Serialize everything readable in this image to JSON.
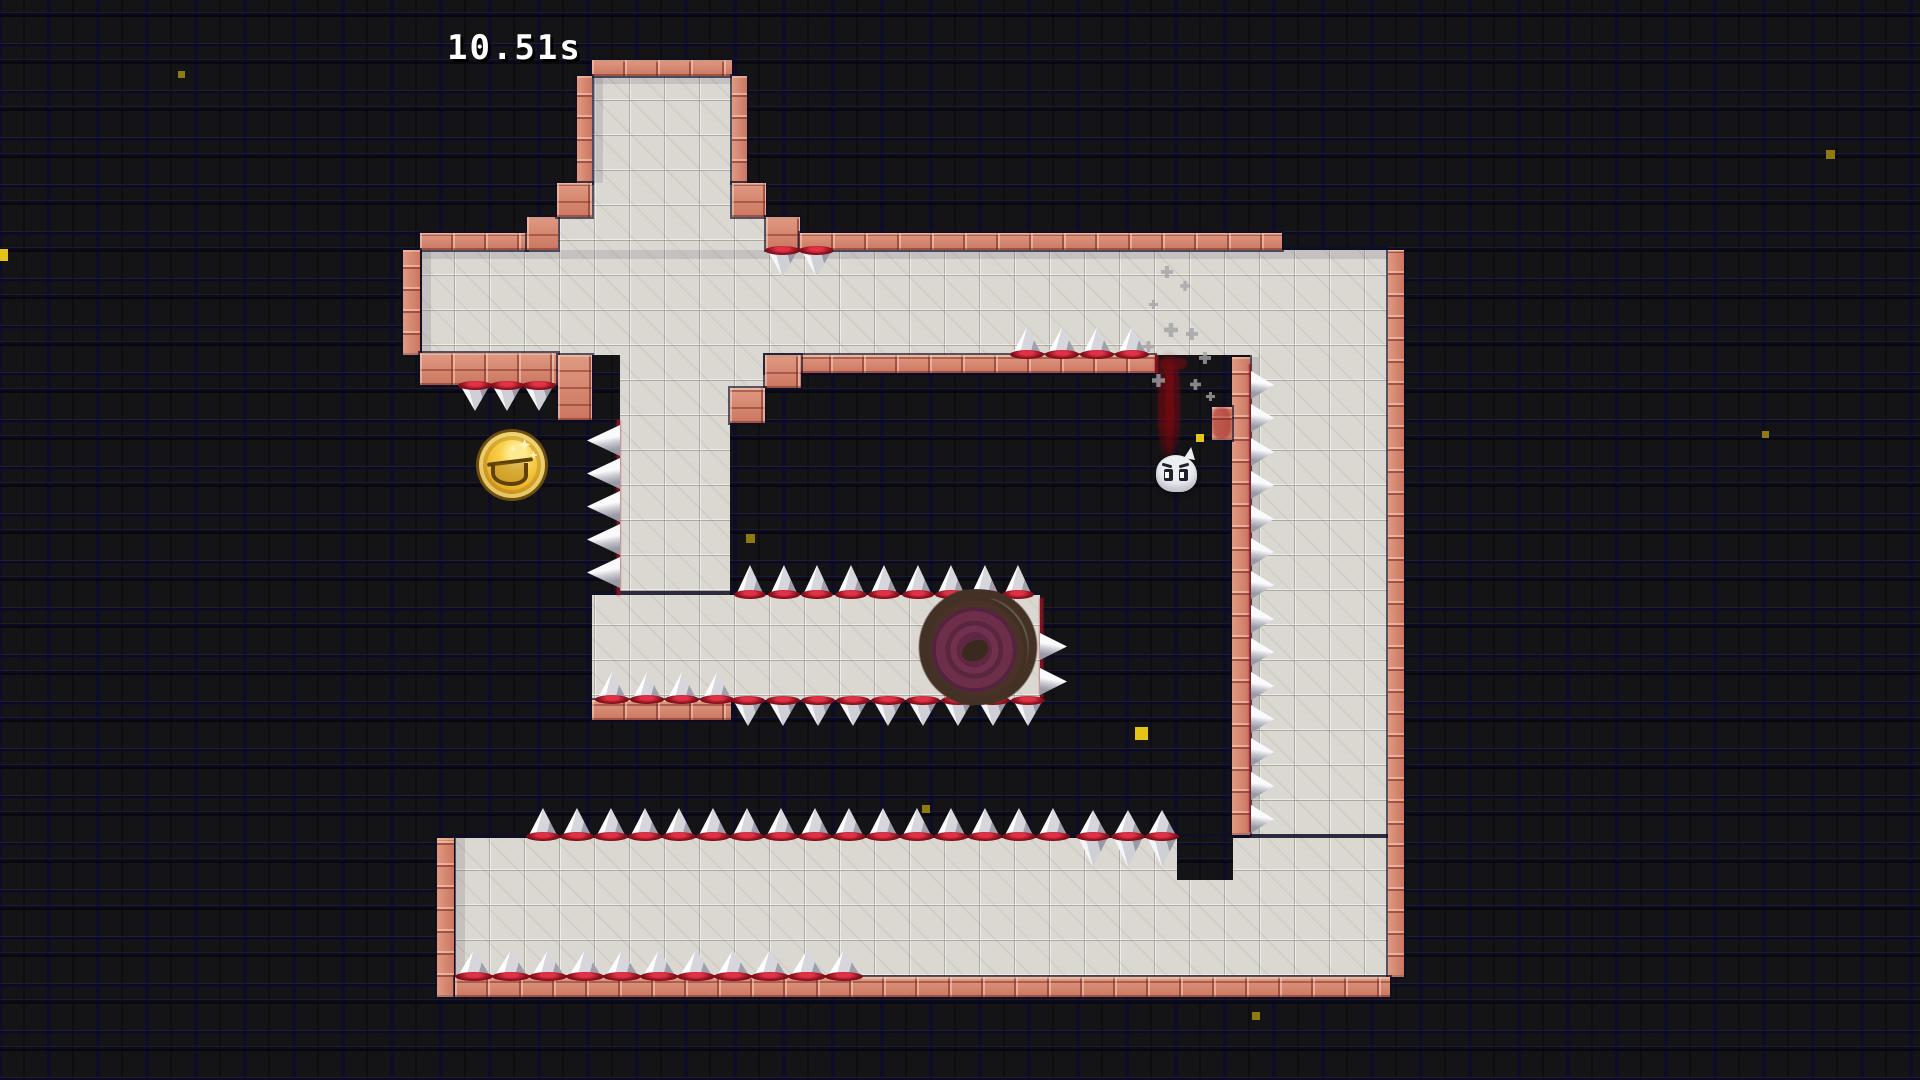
{
  "hud": {
    "timer": "10.51s"
  },
  "palette": {
    "background_tile": "#141417",
    "grout_navy": "#0e0e26",
    "platform_gray": "#dbd8d2",
    "brick_pink": "#d5806a",
    "spike_white": "#f5f5f7",
    "spike_ring_red": "#93121f",
    "coin_gold": "#edb92f",
    "portal_maroon": "#6d2e4a",
    "portal_brown": "#443126",
    "blood_red": "#8b0a0e",
    "particle_yellow": "#e4c418",
    "smoke_gray": "#a3a3a6"
  },
  "entities": {
    "coin": {
      "x": 479,
      "y": 432,
      "size": 66
    },
    "portal": {
      "x": 922,
      "y": 596,
      "w": 112,
      "h": 102
    },
    "ghost": {
      "x": 1156,
      "y": 455,
      "w": 41,
      "h": 37
    },
    "blood": {
      "streaks": [
        {
          "x": 1158,
          "y": 350,
          "w": 22,
          "h": 110,
          "o": 0.5
        },
        {
          "x": 1165,
          "y": 357,
          "w": 9,
          "h": 100,
          "o": 0.55
        }
      ],
      "pool": {
        "x": 1159,
        "y": 357,
        "w": 28,
        "h": 13,
        "o": 0.5
      },
      "wall_smear": {
        "x": 1212,
        "y": 407,
        "w": 19,
        "h": 32,
        "o": 0.45
      }
    },
    "smoke_puffs": [
      [
        1161,
        266,
        12
      ],
      [
        1180,
        281,
        10
      ],
      [
        1149,
        300,
        9
      ],
      [
        1164,
        323,
        14
      ],
      [
        1186,
        328,
        12
      ],
      [
        1143,
        341,
        11
      ],
      [
        1199,
        352,
        12
      ],
      [
        1152,
        374,
        13
      ],
      [
        1190,
        379,
        11
      ],
      [
        1206,
        392,
        9
      ]
    ],
    "particles": [
      [
        -4,
        249,
        12,
        1
      ],
      [
        178,
        71,
        7,
        0
      ],
      [
        746,
        534,
        9,
        0
      ],
      [
        922,
        805,
        8,
        0
      ],
      [
        1135,
        727,
        13,
        1
      ],
      [
        1196,
        434,
        8,
        1
      ],
      [
        1252,
        1012,
        8,
        0
      ],
      [
        1826,
        150,
        9,
        0
      ],
      [
        1762,
        431,
        7,
        0
      ]
    ]
  },
  "spikes": {
    "rows": [
      {
        "name": "band-ceiling-spikes",
        "dir": "down",
        "x": 767,
        "y": 250,
        "n": 2,
        "step": 34,
        "w": 31,
        "h": 27,
        "ring": true,
        "shadow": false
      },
      {
        "name": "band-floor-spikes",
        "dir": "up",
        "x": 1012,
        "y": 355,
        "n": 4,
        "step": 35,
        "w": 30,
        "h": 28,
        "ring": true,
        "shadow": true
      },
      {
        "name": "left-ledge-down-spikes",
        "dir": "down",
        "x": 460,
        "y": 385,
        "n": 3,
        "step": 32,
        "w": 30,
        "h": 26,
        "ring": true,
        "shadow": false
      },
      {
        "name": "coin-wall-spikes",
        "dir": "left",
        "x": 620,
        "y": 425,
        "n": 5,
        "step": 33,
        "w": 33,
        "h": 31,
        "ring": false,
        "shadow": false
      },
      {
        "name": "column-floor-spikes",
        "dir": "up",
        "x": 597,
        "y": 700,
        "n": 4,
        "step": 35,
        "w": 30,
        "h": 28,
        "ring": true,
        "shadow": false
      },
      {
        "name": "stub-top-spikes",
        "dir": "up",
        "x": 736,
        "y": 595,
        "n": 9,
        "step": 33.5,
        "w": 28,
        "h": 30,
        "ring": true,
        "shadow": true
      },
      {
        "name": "stub-bottom-spikes",
        "dir": "down",
        "x": 733,
        "y": 700,
        "n": 9,
        "step": 35,
        "w": 30,
        "h": 26,
        "ring": true,
        "shadow": false
      },
      {
        "name": "stub-right-spikes",
        "dir": "right",
        "x": 1040,
        "y": 633,
        "n": 2,
        "step": 35,
        "w": 27,
        "h": 27,
        "ring": false,
        "shadow": false
      },
      {
        "name": "inner-wall-spikes",
        "dir": "right",
        "x": 1251,
        "y": 371,
        "n": 14,
        "step": 33.4,
        "w": 23,
        "h": 28,
        "ring": false,
        "shadow": false
      },
      {
        "name": "bottom-band-top-spikes",
        "dir": "up",
        "x": 528,
        "y": 837,
        "n": 16,
        "step": 34,
        "w": 30,
        "h": 29,
        "ring": true,
        "shadow": false
      },
      {
        "name": "bottom-floor-spikes",
        "dir": "up",
        "x": 457,
        "y": 977,
        "n": 11,
        "step": 37,
        "w": 34,
        "h": 27,
        "ring": true,
        "shadow": true
      }
    ],
    "double_spikes": {
      "name": "band-edge-double-spikes",
      "x": 1078,
      "center_y": 837,
      "n": 3,
      "step": 34.5,
      "w": 30,
      "h_up": 27,
      "h_down": 30
    }
  }
}
